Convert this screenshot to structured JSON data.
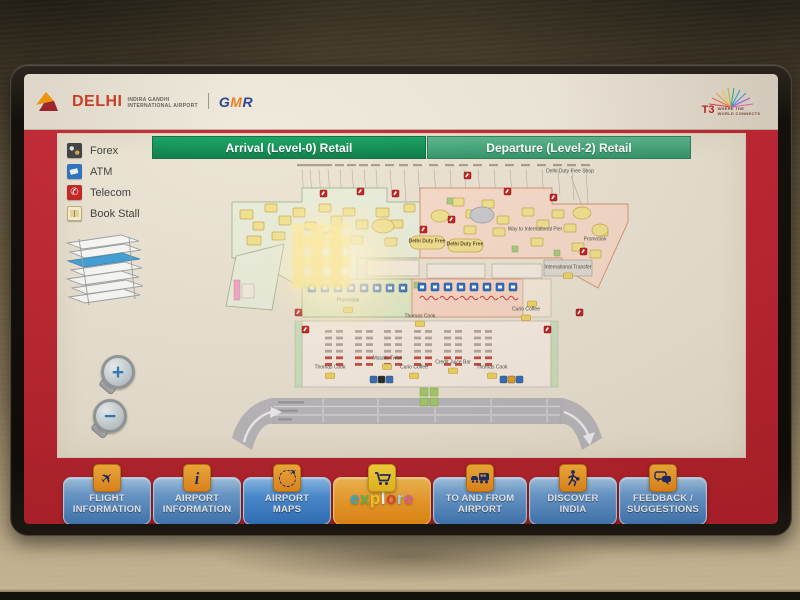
{
  "header": {
    "delhi": {
      "name": "DELHI",
      "line1": "INDIRA GANDHI",
      "line2": "INTERNATIONAL AIRPORT"
    },
    "gmr": {
      "g": "G",
      "m": "M",
      "r": "R"
    },
    "t3": {
      "name": "T3",
      "tag1": "WHERE THE",
      "tag2": "WORLD CONNECTS"
    }
  },
  "tabs": {
    "arrival": "Arrival (Level-0) Retail",
    "departure": "Departure (Level-2) Retail"
  },
  "legend": {
    "forex": "Forex",
    "atm": "ATM",
    "telecom": "Telecom",
    "book": "Book Stall"
  },
  "zoom_controls": {
    "zoom_in": "+",
    "zoom_out": "−"
  },
  "map_labels": {
    "duty_free_a": "Delhi Duty Free",
    "duty_free_b": "Delhi Duty Free",
    "duty_free_shop": "Delhi Duty Free Shop",
    "way_pier": "Way to International Pier",
    "promotion_right": "Promotion",
    "promotion_mid": "Promotion",
    "intl_transfer": "International Transfer",
    "curio_right": "Curio Coffee",
    "thomas_top": "Thomas Cook",
    "thomas_left": "Thomas Cook",
    "masala": "Masala Twist",
    "curio_center": "Curio Coffee",
    "juice_bar": "Credit Juice Bar",
    "thomas_right": "Thomas Cook"
  },
  "nav": {
    "flight": {
      "line1": "FLIGHT",
      "line2": "INFORMATION",
      "icon_char": "✈"
    },
    "airport_info": {
      "line1": "AIRPORT",
      "line2": "INFORMATION",
      "icon_char": "i"
    },
    "airport_maps": {
      "line1": "AIRPORT",
      "line2": "MAPS",
      "icon_char": "✈"
    },
    "explore": {
      "letters": [
        "e",
        "x",
        "p",
        "l",
        "o",
        "r",
        "e"
      ]
    },
    "to_from": {
      "line1": "TO AND FROM",
      "line2": "AIRPORT"
    },
    "discover": {
      "line1": "DISCOVER",
      "line2": "INDIA"
    },
    "feedback": {
      "line1": "FEEDBACK /",
      "line2": "SUGGESTIONS"
    }
  },
  "colors": {
    "frame_red": "#bf2430",
    "tab_green_dark": "#0b9156",
    "tab_green_light": "#45a97b",
    "nav_blue": "#4a86c4",
    "nav_blue_active": "#3b87d8",
    "explore_orange": "#f39b27"
  }
}
